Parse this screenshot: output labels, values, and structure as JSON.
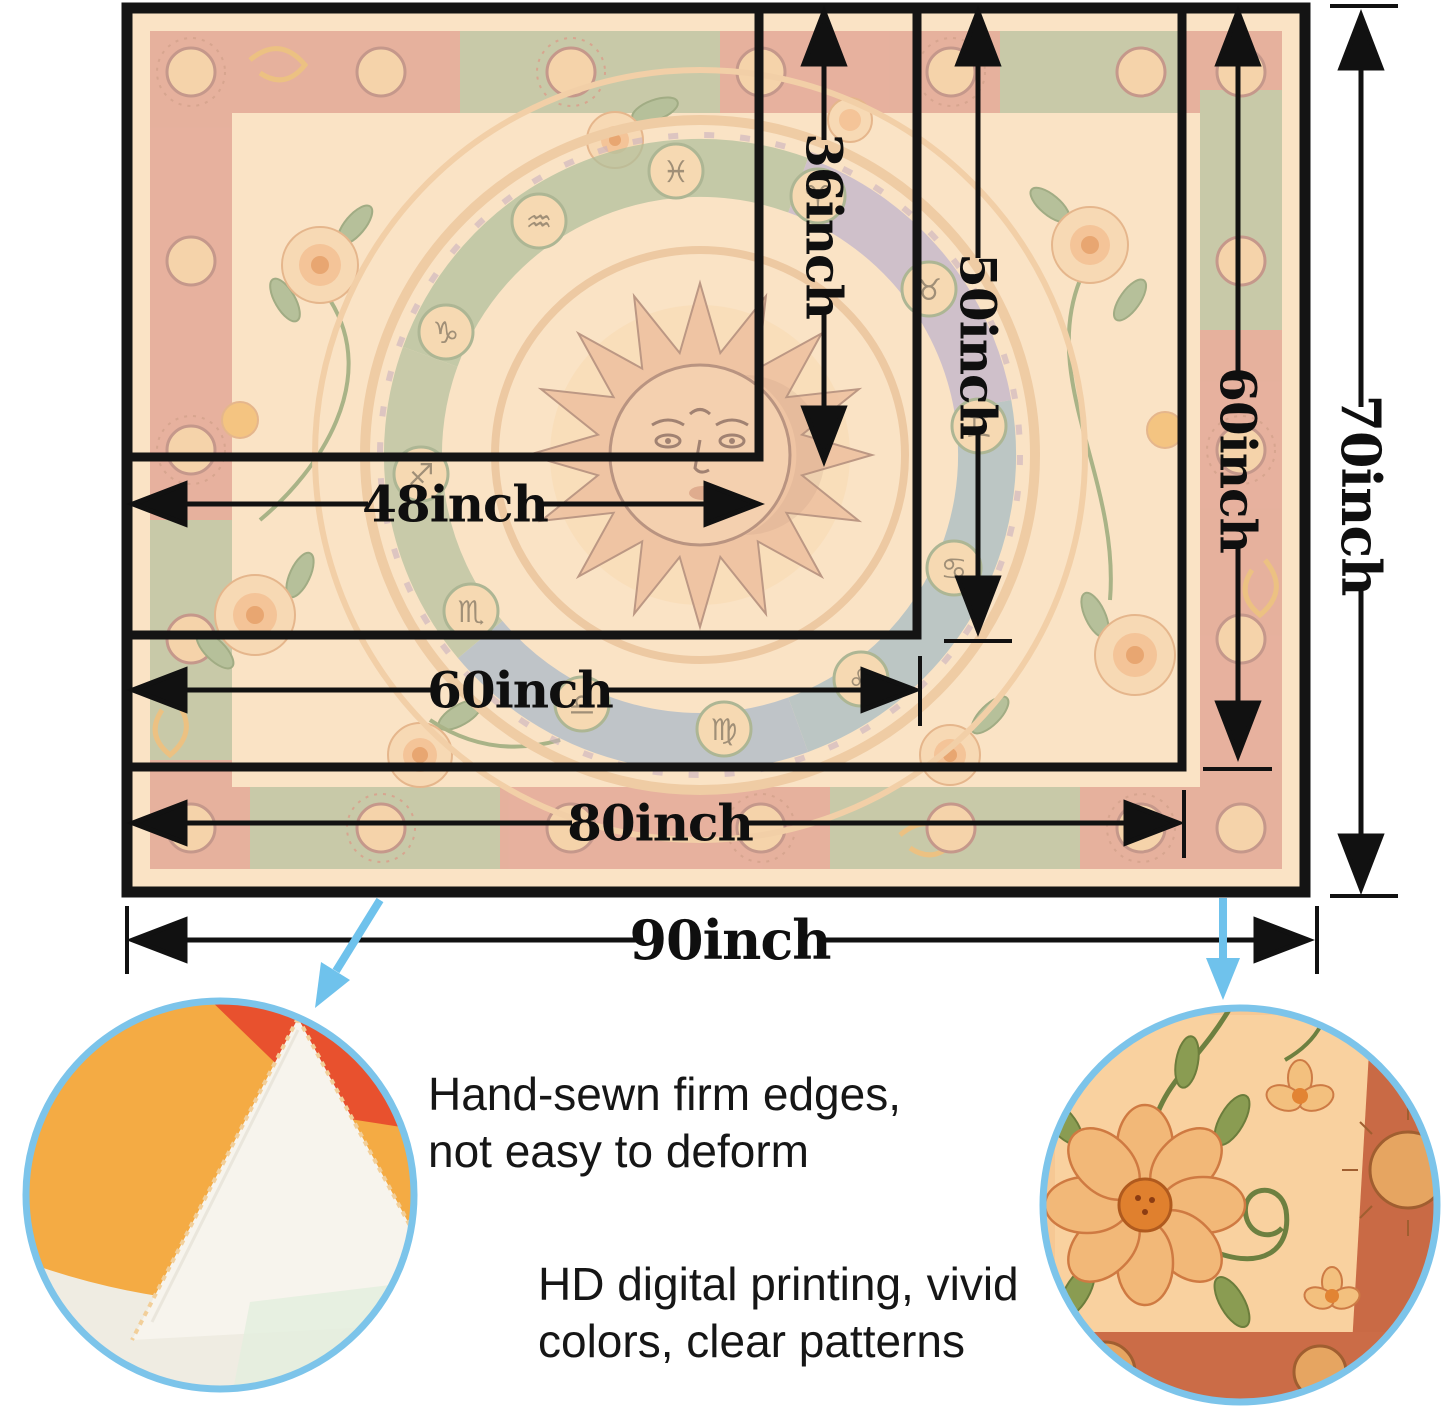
{
  "size_chart": {
    "width_labels": {
      "w48": "48inch",
      "w60": "60inch",
      "w80": "80inch",
      "w90": "90inch"
    },
    "height_labels": {
      "h36": "36inch",
      "h50": "50inch",
      "h60": "60inch",
      "h70": "70inch"
    },
    "sizes": [
      {
        "width": "48inch",
        "height": "36inch"
      },
      {
        "width": "60inch",
        "height": "50inch"
      },
      {
        "width": "80inch",
        "height": "60inch"
      },
      {
        "width": "90inch",
        "height": "70inch"
      }
    ]
  },
  "features": [
    {
      "line1": "Hand-sewn firm edges,",
      "line2": "not easy to deform"
    },
    {
      "line1": "HD digital printing, vivid",
      "line2": "colors, clear patterns"
    }
  ],
  "tapestry": {
    "theme": "sun and zodiac floral tapestry",
    "zodiac_symbols": [
      "♈",
      "♉",
      "♊",
      "♋",
      "♌",
      "♍",
      "♎",
      "♏",
      "♐",
      "♑",
      "♒",
      "♓"
    ]
  },
  "colors": {
    "dimension_ink": "#111111",
    "callout_blue": "#6fc2ec",
    "circle_border": "#7cc4ea",
    "tapestry_background": "#f8ddba",
    "border_band_pink": "#d98c7a",
    "border_band_green": "#a9b48c",
    "sun_skin": "#f0c39c"
  }
}
